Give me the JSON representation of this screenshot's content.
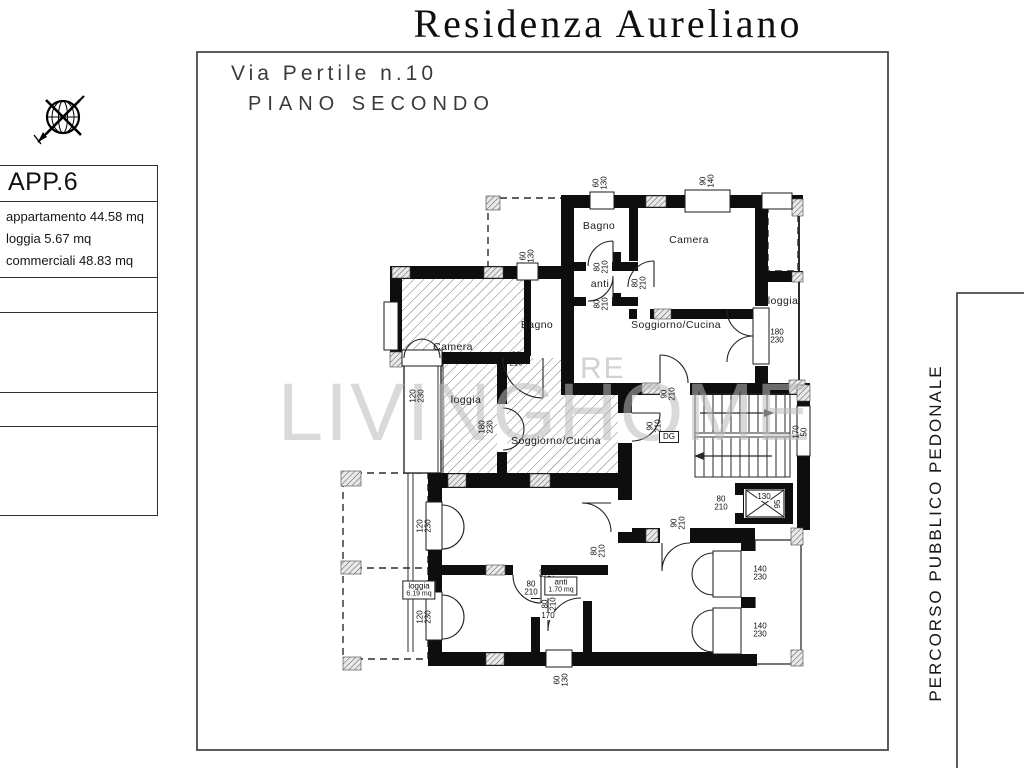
{
  "header": {
    "title": "Residenza Aureliano",
    "address_line1": "Via Pertile n.10",
    "address_line2": "PIANO SECONDO"
  },
  "info_box": {
    "title": "APP.6",
    "lines": [
      "appartamento 44.58 mq",
      "loggia 5.67 mq",
      "commerciali 48.83 mq"
    ]
  },
  "side_label": "PERCORSO PUBBLICO PEDONALE",
  "watermark": {
    "main": "LIVINGHOME",
    "fragment": "RE"
  },
  "plan": {
    "rooms": [
      {
        "label": "Bagno",
        "x": 599,
        "y": 226
      },
      {
        "label": "Camera",
        "x": 689,
        "y": 240
      },
      {
        "label": "anti",
        "x": 600,
        "y": 284
      },
      {
        "label": "Soggiorno/Cucina",
        "x": 676,
        "y": 325
      },
      {
        "label": "loggia",
        "x": 783,
        "y": 301
      },
      {
        "label": "Camera",
        "x": 453,
        "y": 347
      },
      {
        "label": "Bagno",
        "x": 537,
        "y": 325
      },
      {
        "label": "loggia",
        "x": 466,
        "y": 400
      },
      {
        "label": "Soggiorno/Cucina",
        "x": 556,
        "y": 441
      }
    ],
    "dimensions": [
      {
        "lines": [
          "60",
          "130"
        ],
        "x": 600,
        "y": 183,
        "rot": true
      },
      {
        "lines": [
          "90",
          "140"
        ],
        "x": 707,
        "y": 181,
        "rot": true
      },
      {
        "lines": [
          "80",
          "210"
        ],
        "x": 601,
        "y": 267,
        "rot": true
      },
      {
        "lines": [
          "80",
          "210"
        ],
        "x": 601,
        "y": 304,
        "rot": true
      },
      {
        "lines": [
          "80",
          "210"
        ],
        "x": 639,
        "y": 283,
        "rot": true
      },
      {
        "lines": [
          "180",
          "230"
        ],
        "x": 777,
        "y": 336,
        "rot": false
      },
      {
        "lines": [
          "60",
          "130"
        ],
        "x": 527,
        "y": 256,
        "rot": true
      },
      {
        "lines": [
          "80",
          "210"
        ],
        "x": 516,
        "y": 359,
        "rot": false
      },
      {
        "lines": [
          "120",
          "230"
        ],
        "x": 417,
        "y": 396,
        "rot": true
      },
      {
        "lines": [
          "180",
          "230"
        ],
        "x": 486,
        "y": 427,
        "rot": true
      },
      {
        "lines": [
          "90",
          "210"
        ],
        "x": 654,
        "y": 426,
        "rot": true
      },
      {
        "lines": [
          "90",
          "210"
        ],
        "x": 668,
        "y": 394,
        "rot": true
      },
      {
        "lines": [
          "170",
          "50"
        ],
        "x": 800,
        "y": 432,
        "rot": true
      },
      {
        "lines": [
          "80",
          "210"
        ],
        "x": 721,
        "y": 503,
        "rot": false
      },
      {
        "lines": [
          "90",
          "210"
        ],
        "x": 678,
        "y": 523,
        "rot": true
      },
      {
        "lines": [
          "140",
          "230"
        ],
        "x": 760,
        "y": 573,
        "rot": false
      },
      {
        "lines": [
          "140",
          "230"
        ],
        "x": 760,
        "y": 630,
        "rot": false
      },
      {
        "lines": [
          "120",
          "230"
        ],
        "x": 424,
        "y": 526,
        "rot": true
      },
      {
        "lines": [
          "120",
          "230"
        ],
        "x": 424,
        "y": 617,
        "rot": true
      },
      {
        "lines": [
          "80",
          "210"
        ],
        "x": 598,
        "y": 551,
        "rot": true
      },
      {
        "lines": [
          "80",
          "210"
        ],
        "x": 547,
        "y": 573,
        "rot": true
      },
      {
        "lines": [
          "80",
          "210"
        ],
        "x": 531,
        "y": 588,
        "rot": false
      },
      {
        "lines": [
          "80",
          "210"
        ],
        "x": 549,
        "y": 604,
        "rot": true
      },
      {
        "lines": [
          "60",
          "130"
        ],
        "x": 561,
        "y": 680,
        "rot": true
      }
    ],
    "tags": [
      {
        "lines": [
          "loggia",
          "6.19 mq"
        ],
        "x": 419,
        "y": 590,
        "boxed": true,
        "rot": false
      },
      {
        "lines": [
          "anti",
          "1.70 mq"
        ],
        "x": 561,
        "y": 586,
        "boxed": true,
        "rot": false
      },
      {
        "lines": [
          "DG"
        ],
        "x": 669,
        "y": 437,
        "boxed": true,
        "rot": false
      },
      {
        "lines": [
          "170"
        ],
        "x": 548,
        "y": 616,
        "boxed": false,
        "rot": false
      },
      {
        "lines": [
          "130"
        ],
        "x": 764,
        "y": 497,
        "boxed": false,
        "rot": false
      },
      {
        "lines": [
          "95"
        ],
        "x": 778,
        "y": 504,
        "boxed": false,
        "rot": true
      }
    ]
  }
}
